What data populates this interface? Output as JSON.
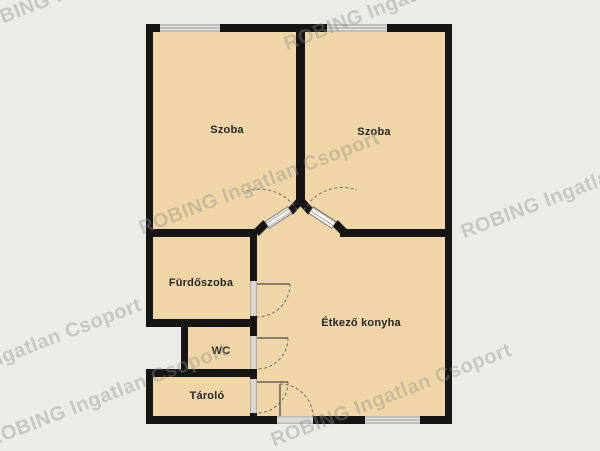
{
  "plan": {
    "rooms": [
      {
        "id": "szoba-left",
        "label": "Szoba"
      },
      {
        "id": "szoba-right",
        "label": "Szoba"
      },
      {
        "id": "furdoszoba",
        "label": "Fürdőszoba"
      },
      {
        "id": "wc",
        "label": "WC"
      },
      {
        "id": "tarolo",
        "label": "Tároló"
      },
      {
        "id": "etkezo-konyha",
        "label": "Étkező konyha"
      }
    ]
  },
  "watermark": {
    "text": "ROBING Ingatlan Csoport"
  },
  "colors": {
    "background": "#ecebe8",
    "room_fill": "#f0d6a6",
    "wall": "#151515",
    "label": "#262626",
    "watermark": "#8f8d87"
  }
}
